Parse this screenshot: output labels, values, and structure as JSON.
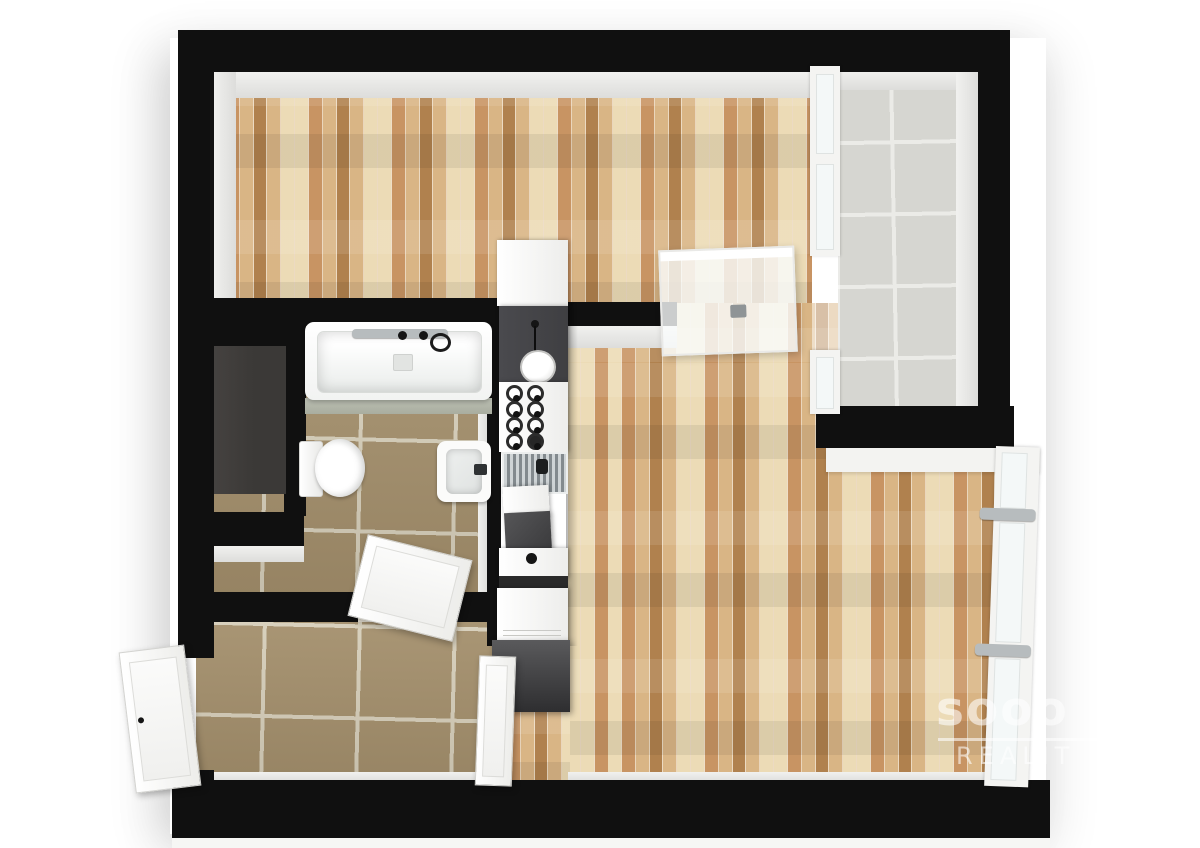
{
  "scene": {
    "kind": "3D floor plan render, top-down view of a one-bedroom apartment",
    "background": "#ffffff"
  },
  "watermark": {
    "brand": "sooo",
    "word": "REALIT"
  },
  "colors": {
    "wall": "#101010",
    "wall_face": "#f1f1ef",
    "face_shade": "#dddddb",
    "wood_a": "#ecdbb6",
    "wood_b": "#d9b585",
    "wood_c": "#c89463",
    "wood_d": "#b0814e",
    "tile_bath": "#a5906c",
    "grout_bath": "#d9d1bc",
    "tile_balcony": "#d6d6d1",
    "grout_balcony": "#ebebe7",
    "fixture": "#fafaf9",
    "counter_dark": "#3f3f42",
    "niche_floor": "#3b3937",
    "tub_deck": "#bcc0b4",
    "chrome": "#b7bcbe",
    "glass": "#f4f8f8",
    "watermark": "rgba(255,255,255,0.58)"
  },
  "rooms": [
    {
      "id": "main-room",
      "floor": "wood parquet"
    },
    {
      "id": "living-room",
      "floor": "wood parquet"
    },
    {
      "id": "bathroom",
      "floor": "beige ceramic tile",
      "fixtures": [
        "bathtub",
        "wall shower mixer",
        "toilet",
        "washbasin"
      ]
    },
    {
      "id": "storage-niche",
      "floor": "dark gray"
    },
    {
      "id": "hallway",
      "floor": "beige ceramic tile"
    },
    {
      "id": "balcony",
      "floor": "light gray tile"
    }
  ],
  "kitchen": {
    "layout": "galley strip between bathroom wall and living room",
    "elements": [
      "white tall cabinet",
      "dark counter with pendant lamp",
      "burner hob (8 rings)",
      "sink with drainboard",
      "white module",
      "dark module",
      "counter with drain",
      "white appliance",
      "dark refrigerator block"
    ]
  },
  "doors": [
    {
      "id": "entry-door",
      "state": "open"
    },
    {
      "id": "bathroom-door",
      "state": "open"
    },
    {
      "id": "living-room-door",
      "state": "open"
    },
    {
      "id": "balcony-door",
      "state": "open",
      "material": "glass"
    }
  ],
  "windows": [
    {
      "id": "living-room-window-wall",
      "panels": 3
    },
    {
      "id": "balcony-glazing",
      "panels": 2
    }
  ]
}
